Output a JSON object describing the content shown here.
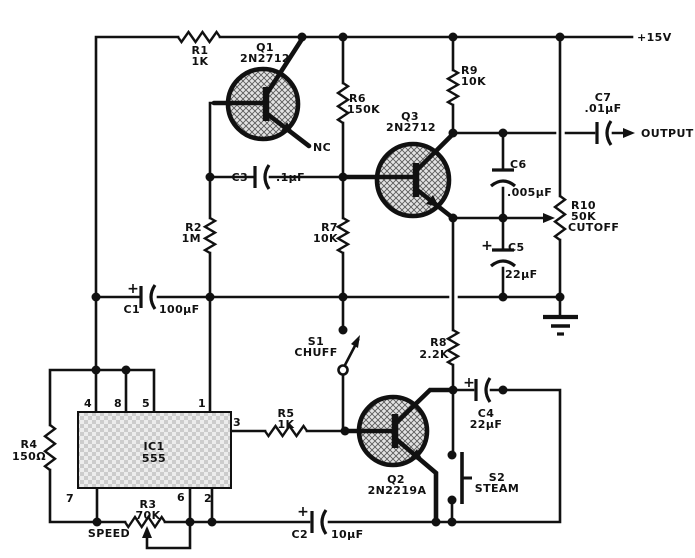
{
  "labels": {
    "supply": "+15V",
    "output": "OUTPUT",
    "nc": "NC"
  },
  "resistors": {
    "r1": {
      "ref": "R1",
      "value": "1K"
    },
    "r2": {
      "ref": "R2",
      "value": "1M"
    },
    "r3": {
      "ref": "R3",
      "value": "70K",
      "function": "SPEED"
    },
    "r4": {
      "ref": "R4",
      "value": "150Ω"
    },
    "r5": {
      "ref": "R5",
      "value": "1K"
    },
    "r6": {
      "ref": "R6",
      "value": "150K"
    },
    "r7": {
      "ref": "R7",
      "value": "10K"
    },
    "r8": {
      "ref": "R8",
      "value": "2.2K"
    },
    "r9": {
      "ref": "R9",
      "value": "10K"
    },
    "r10": {
      "ref": "R10",
      "value": "50K",
      "function": "CUTOFF"
    }
  },
  "capacitors": {
    "c1": {
      "ref": "C1",
      "value": "100μF",
      "polarity": "+"
    },
    "c2": {
      "ref": "C2",
      "value": "10μF",
      "polarity": "+"
    },
    "c3": {
      "ref": "C3",
      "value": ".1μF"
    },
    "c4": {
      "ref": "C4",
      "value": "22μF",
      "polarity": "+"
    },
    "c5": {
      "ref": "C5",
      "value": "22μF",
      "polarity": "+"
    },
    "c6": {
      "ref": "C6",
      "value": ".005μF"
    },
    "c7": {
      "ref": "C7",
      "value": ".01μF"
    }
  },
  "transistors": {
    "q1": {
      "ref": "Q1",
      "part": "2N2712"
    },
    "q2": {
      "ref": "Q2",
      "part": "2N2219A"
    },
    "q3": {
      "ref": "Q3",
      "part": "2N2712"
    }
  },
  "switches": {
    "s1": {
      "ref": "S1",
      "function": "CHUFF"
    },
    "s2": {
      "ref": "S2",
      "function": "STEAM"
    }
  },
  "ic1": {
    "ref": "IC1",
    "part": "555",
    "pins_top": [
      "4",
      "8",
      "5",
      "1"
    ],
    "pin_right": "3",
    "pins_bottom": [
      "7",
      "6",
      "2"
    ]
  }
}
